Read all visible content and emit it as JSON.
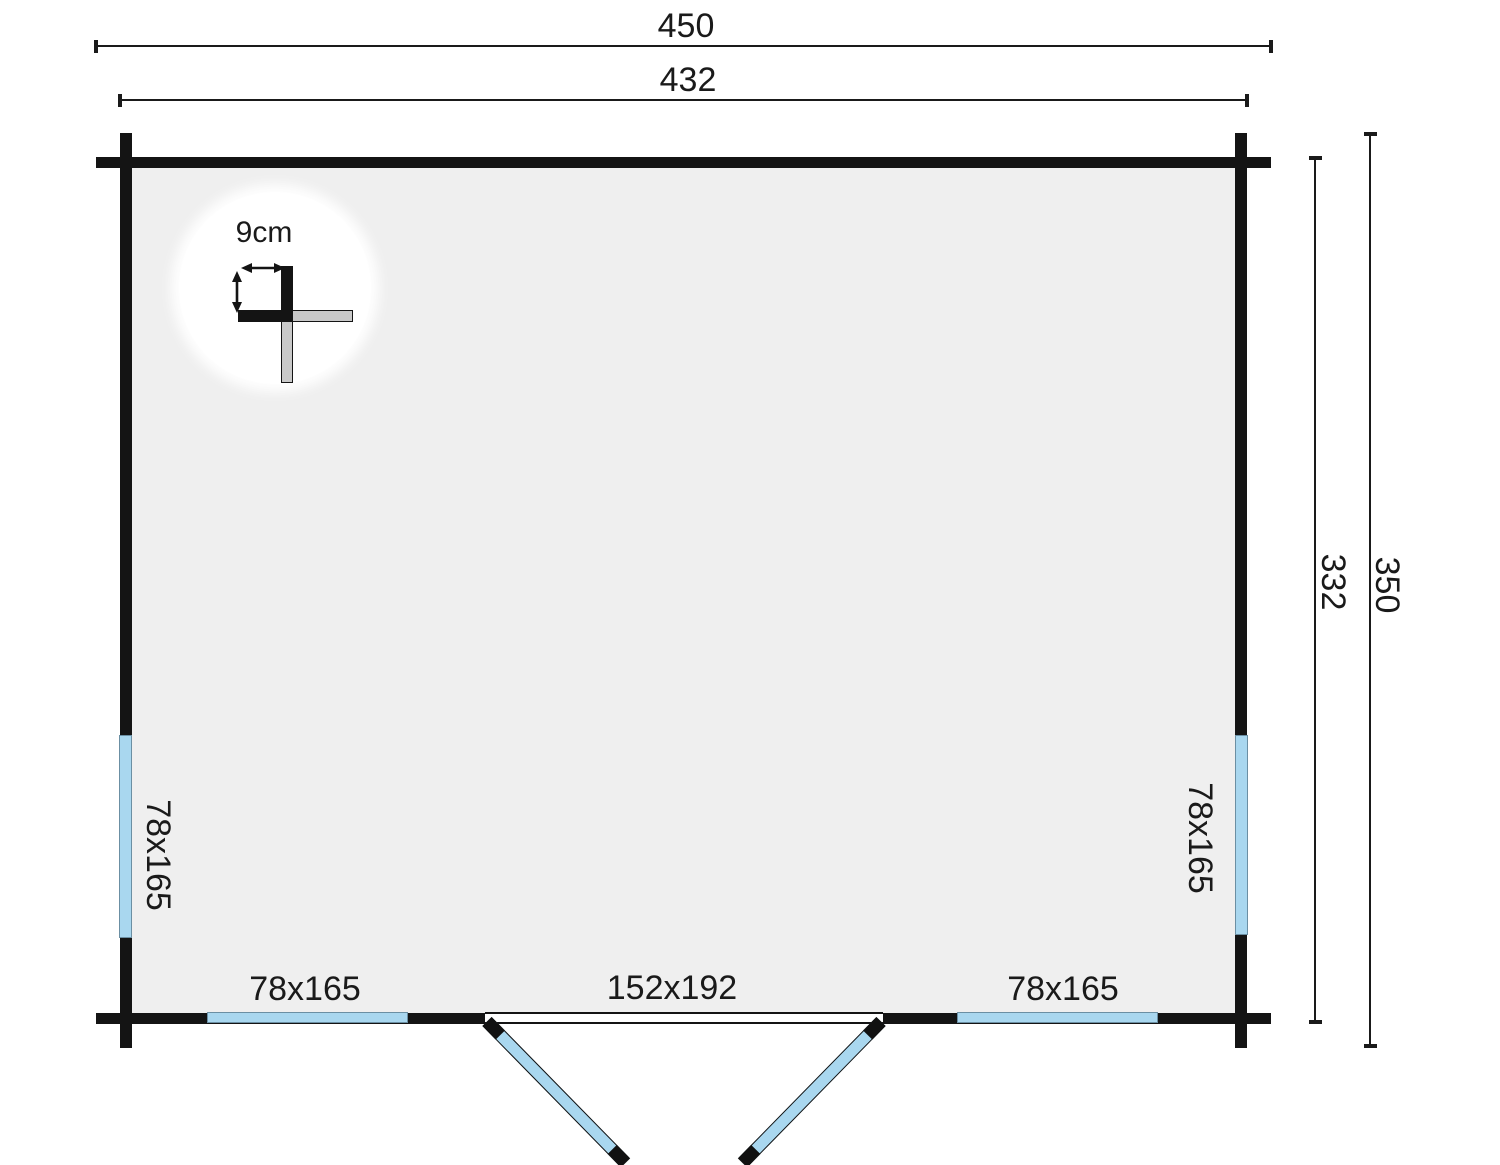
{
  "diagram": {
    "type": "floor-plan",
    "dimensions": {
      "top_outer": "450",
      "top_inner": "432",
      "right_inner": "332",
      "right_outer": "350"
    },
    "detail": {
      "wall_thickness_label": "9cm"
    },
    "windows": {
      "left_label": "78x165",
      "right_label": "78x165",
      "bottom_left_label": "78x165",
      "bottom_right_label": "78x165"
    },
    "door": {
      "label": "152x192"
    },
    "colors": {
      "wall": "#141414",
      "interior": "#efefef",
      "window_blue": "#a9d7ef",
      "detail_log_gray": "#c9c9c9",
      "background": "#ffffff"
    }
  }
}
